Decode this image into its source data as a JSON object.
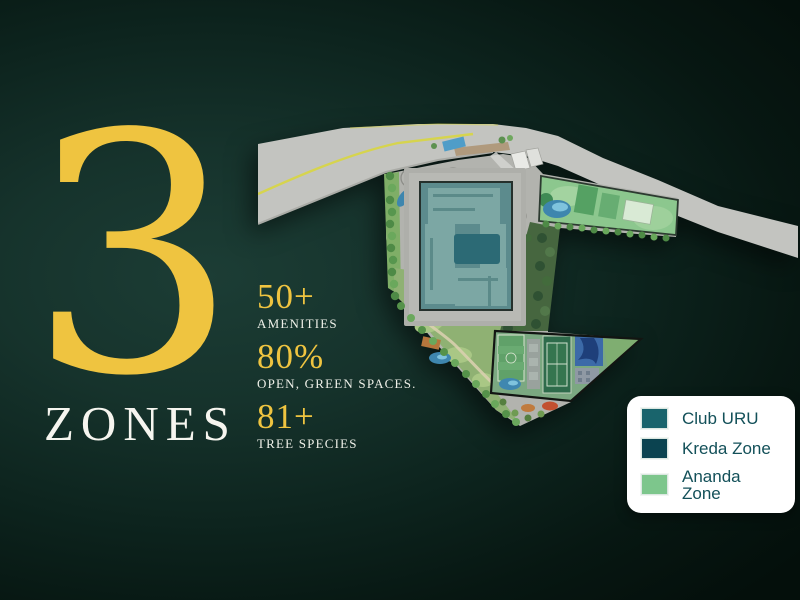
{
  "hero": {
    "count": "3",
    "count_label": "ZONES"
  },
  "stats": [
    {
      "value": "50+",
      "label": "AMENITIES"
    },
    {
      "value": "80%",
      "label": "OPEN, GREEN SPACES."
    },
    {
      "value": "81+",
      "label": "TREE SPECIES"
    }
  ],
  "legend": [
    {
      "label": "Club URU",
      "color": "#19646c"
    },
    {
      "label": "Kreda Zone",
      "color": "#0b4350"
    },
    {
      "label": "Ananda Zone",
      "color": "#7dc68c"
    }
  ],
  "colors": {
    "accent_gold": "#efc440",
    "background_dark_green": "#0d241e",
    "legend_text": "#135059"
  }
}
